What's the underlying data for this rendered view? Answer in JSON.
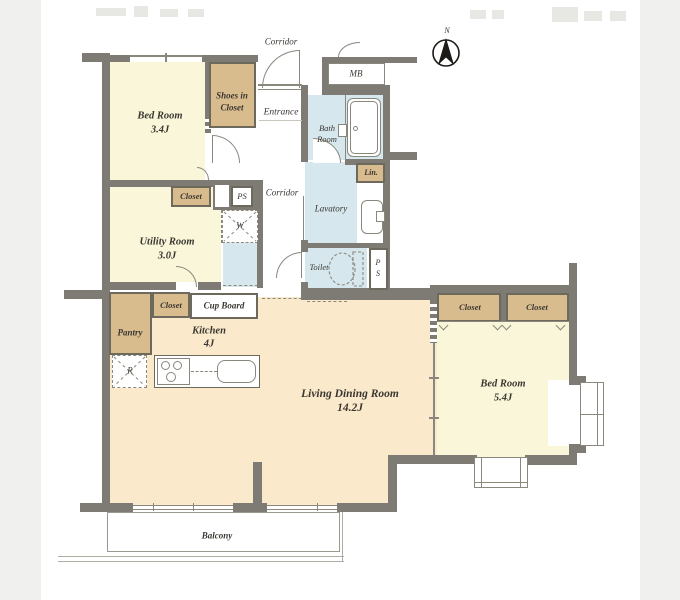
{
  "floorplan": {
    "compass_label": "N",
    "rooms": {
      "bedroom_small": {
        "name": "Bed Room",
        "size": "3.4J"
      },
      "utility": {
        "name": "Utility Room",
        "size": "3.0J"
      },
      "kitchen": {
        "name": "Kitchen",
        "size": "4J"
      },
      "living_dining": {
        "name": "Living Dining Room",
        "size": "14.2J"
      },
      "bedroom_main": {
        "name": "Bed Room",
        "size": "5.4J"
      }
    },
    "labels": {
      "corridor_top": "Corridor",
      "corridor_mid": "Corridor",
      "entrance": "Entrance",
      "shoes_closet_line1": "Shoes in",
      "shoes_closet_line2": "Closet",
      "mb": "MB",
      "bath_line1": "Bath",
      "bath_line2": "Room",
      "lavatory": "Lavatory",
      "lin": "Lin.",
      "toilet": "Toilet",
      "ps_left": "PS",
      "ps_right_line1": "P",
      "ps_right_line2": "S",
      "closet_utility": "Closet",
      "closet_kitchen": "Closet",
      "cup_board": "Cup Board",
      "pantry": "Pantry",
      "washer": "W",
      "refrigerator": "R",
      "closet_bedroom_1": "Closet",
      "closet_bedroom_2": "Closet",
      "balcony": "Balcony"
    },
    "colors": {
      "wall": "#7d7b73",
      "room_yellow": "#f9f6da",
      "room_peach": "#fae9cb",
      "closet_tan": "#d9bc8e",
      "wet_blue": "#d6e8ee",
      "background": "#f0f0ee",
      "text": "#3a3731"
    }
  }
}
